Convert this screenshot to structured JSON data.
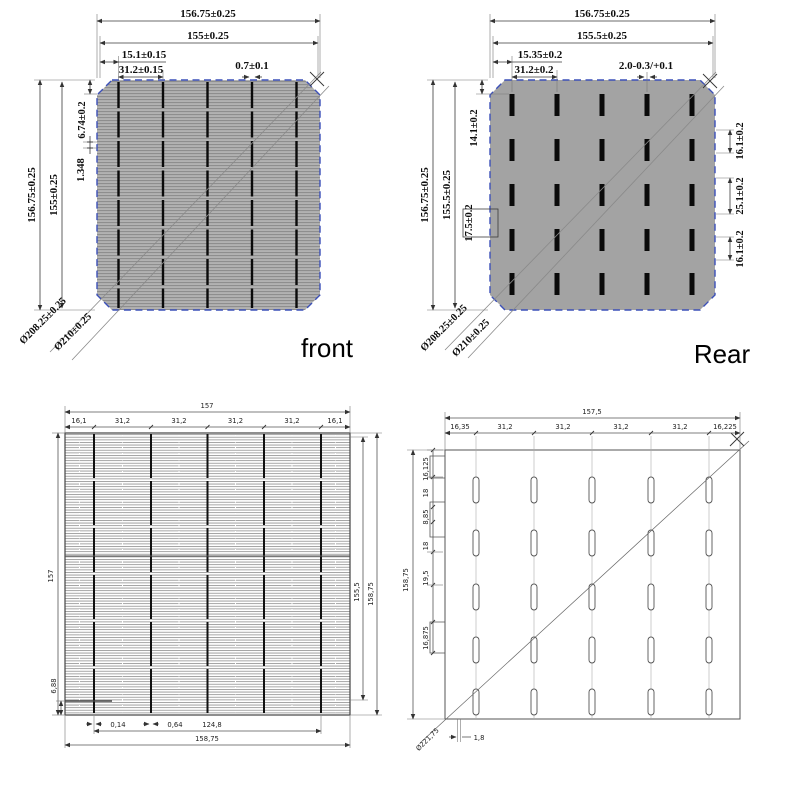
{
  "colors": {
    "cell_gray_front": "#b2b2b2",
    "cell_finger_line": "#8e8e8e",
    "cell_gray_rear": "#a3a3a3",
    "border_blue": "#3c50b8",
    "busbar_black": "#0a0a0a",
    "dim_line": "#3a3a3a"
  },
  "front": {
    "caption": "front",
    "dim_overall_top": "156.75±0.25",
    "dim_inner_top": "155±0.25",
    "dim_busbar_offset": "15.1±0.15",
    "dim_busbar_pitch": "31.2±0.15",
    "dim_busbar_width": "0.7±0.1",
    "dim_overall_left": "156.75±0.25",
    "dim_inner_left": "155±0.25",
    "dim_edge_clear": "6.74±0.2",
    "dim_finger_pitch": "1.348",
    "dim_diag_inner": "Ø208.25±0.25",
    "dim_diag_outer": "Ø210±0.25"
  },
  "rear": {
    "caption": "Rear",
    "dim_overall_top": "156.75±0.25",
    "dim_inner_top": "155.5±0.25",
    "dim_pad_offset": "15.35±0.2",
    "dim_pad_pitch": "31.2±0.2",
    "dim_pad_width": "2.0-0.3/+0.1",
    "dim_overall_left": "156.75±0.25",
    "dim_inner_left": "155.5±0.25",
    "dim_pad_top": "14.1±0.2",
    "dim_pad_gap": "17.5±0.2",
    "dim_right_top": "16.1±0.2",
    "dim_right_mid": "25.1±0.2",
    "dim_right_bot": "16.1±0.2",
    "dim_diag_inner": "Ø208.25±0.25",
    "dim_diag_outer": "Ø210±0.25"
  },
  "front_cad": {
    "dim_total_top": "157",
    "segments_top": [
      "16,1",
      "31,2",
      "31,2",
      "31,2",
      "31,2",
      "16,1"
    ],
    "dim_left_height": "157",
    "dim_left_bottom": "6,88",
    "dim_right_inner": "155,5",
    "dim_right_outer": "158,75",
    "dim_bottom_1": "0,14",
    "dim_bottom_2": "0,64",
    "dim_bottom_3": "124,8",
    "dim_bottom_total": "158,75"
  },
  "rear_cad": {
    "dim_total_top": "157,5",
    "segments_top": [
      "16,35",
      "31,2",
      "31,2",
      "31,2",
      "31,2",
      "16,225"
    ],
    "left_chain": [
      "16,125",
      "18",
      "8,85",
      "18",
      "19,5",
      "16,875"
    ],
    "dim_left_overall": "158,75",
    "dim_diag": "Ø221,75",
    "dim_bottom": "1,8"
  }
}
